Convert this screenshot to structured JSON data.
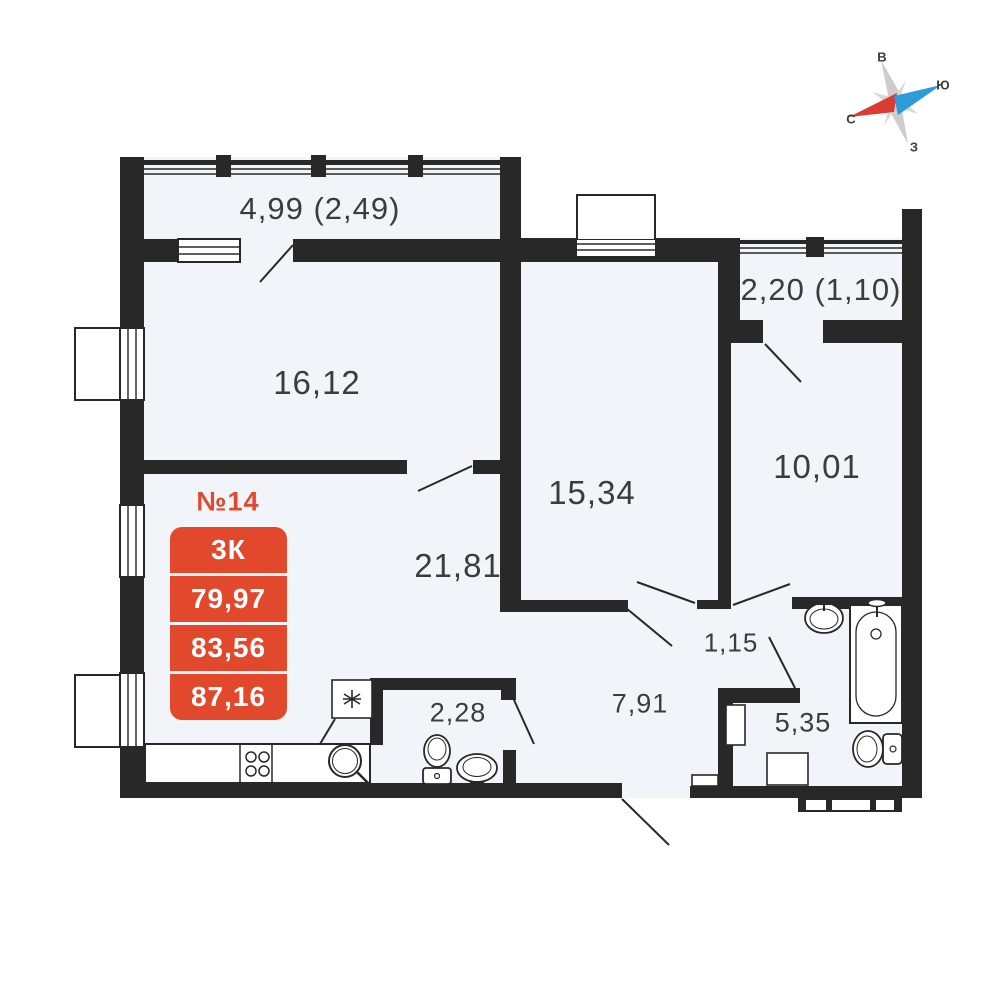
{
  "colors": {
    "wall": "#282828",
    "floor": "#f1f5fa",
    "accent_red": "#e2492c",
    "compass_red": "#dc3b34",
    "compass_blue": "#2e9ad7",
    "compass_gray": "#cdcdcd"
  },
  "badge": {
    "number": "№14",
    "rows": [
      "3К",
      "79,97",
      "83,56",
      "87,16"
    ]
  },
  "room_labels": {
    "balcony_top": "4,99 (2,49)",
    "bedroom_left": "16,12",
    "balcony_right": "2,20 (1,10)",
    "bedroom_mid": "15,34",
    "bedroom_right": "10,01",
    "living": "21,81",
    "lobby": "1,15",
    "hall": "7,91",
    "wc": "2,28",
    "bathroom": "5,35"
  },
  "compass": {
    "top": "В",
    "right": "Ю",
    "left": "С",
    "bottom": "З"
  }
}
